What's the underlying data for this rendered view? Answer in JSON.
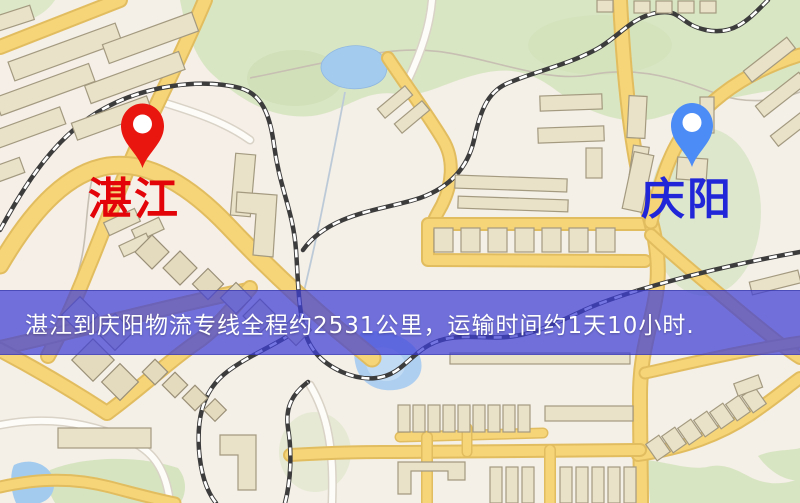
{
  "banner": {
    "text": "湛江到庆阳物流专线全程约2531公里，运输时间约1天10小时.",
    "background_color": "#3e3ed7",
    "text_color": "#ffffff"
  },
  "markers": [
    {
      "id": "origin",
      "label": "湛江",
      "pin_color": "#e9150f",
      "label_color": "#e20409"
    },
    {
      "id": "destination",
      "label": "庆阳",
      "pin_color": "#4b8cf6",
      "label_color": "#2126d8"
    }
  ],
  "map": {
    "type": "street-map-illustration",
    "palette": {
      "background": "#f4efe7",
      "major_road": "#f6d478",
      "major_road_casing": "#e2bd60",
      "minor_road": "#fdfcf9",
      "park_green": "#d9e6c4",
      "water_blue": "#a3cbee",
      "building_fill": "#e9e1c8",
      "building_outline": "#a39a80",
      "railway_dark": "#3c3c3c"
    }
  }
}
